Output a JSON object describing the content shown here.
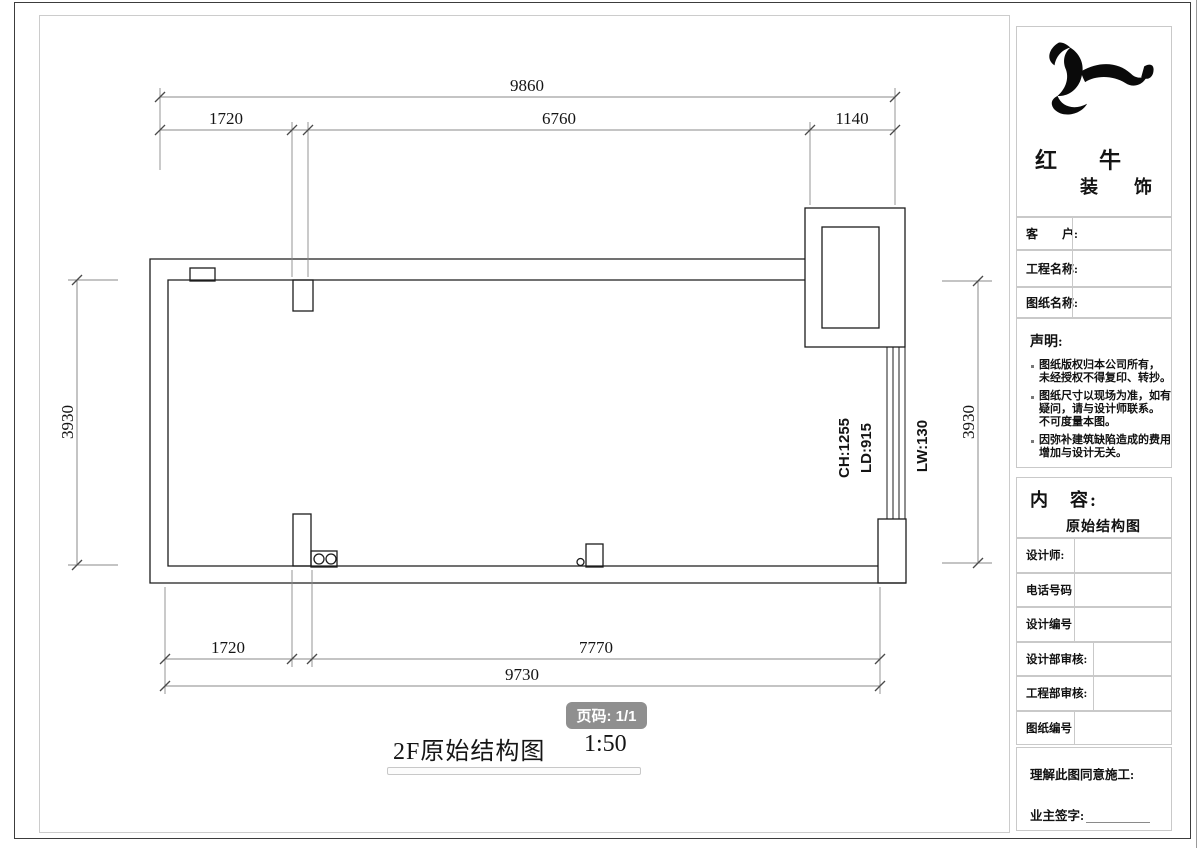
{
  "page": {
    "title": "2F原始结构图",
    "scale_label": "1:50",
    "page_badge": "页码: 1/1"
  },
  "plan": {
    "dims": {
      "top_total": "9860",
      "top_seg1": "1720",
      "top_seg2": "6760",
      "top_seg3": "1140",
      "left_side": "3930",
      "right_side": "3930",
      "bottom_seg1": "1720",
      "bottom_seg2": "7770",
      "bottom_total": "9730"
    },
    "labels": {
      "window_ch": "CH:1255",
      "window_ld": "LD:915",
      "window_lw": "LW:130"
    }
  },
  "sidebar": {
    "brand": {
      "line1": "红　牛",
      "line2": "装　饰"
    },
    "info_rows": [
      {
        "label": "客　　户:"
      },
      {
        "label": "工程名称:"
      },
      {
        "label": "图纸名称:"
      }
    ],
    "statement": {
      "heading": "声明:",
      "lines": [
        {
          "text": "图纸版权归本公司所有，"
        },
        {
          "text": "未经授权不得复印、转抄。"
        },
        {
          "text": "图纸尺寸以现场为准，如有"
        },
        {
          "text": "疑问，请与设计师联系。"
        },
        {
          "text": "不可度量本图。"
        },
        {
          "text": "因弥补建筑缺陷造成的费用"
        },
        {
          "text": "增加与设计无关。"
        }
      ]
    },
    "content": {
      "heading": "内　容:",
      "value": "原始结构图"
    },
    "field_rows": [
      {
        "label": "设计师:"
      },
      {
        "label": "电话号码"
      },
      {
        "label": "设计编号"
      },
      {
        "label": "设计部审核:"
      },
      {
        "label": "工程部审核:"
      },
      {
        "label": "图纸编号"
      }
    ],
    "signature": {
      "line1": "理解此图同意施工:",
      "line2": "业主签字:"
    }
  },
  "colors": {
    "wall_line": "#1c1c1c",
    "dim_line": "#8a8a8a",
    "frame": "#c9c9c9",
    "badge": "#8f8f8f"
  }
}
